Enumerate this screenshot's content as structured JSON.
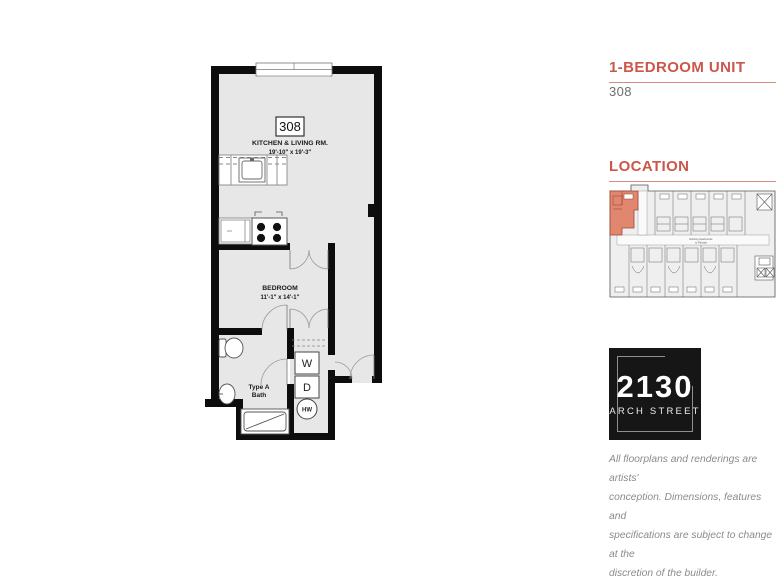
{
  "header": {
    "unit_type_heading": "1-BEDROOM UNIT",
    "unit_number": "308",
    "location_heading": "LOCATION"
  },
  "floorplan": {
    "unit_number": "308",
    "rooms": {
      "living": {
        "name": "KITCHEN & LIVING RM.",
        "dimensions": "19'-10\" x 19'-3\""
      },
      "bedroom": {
        "name": "BEDROOM",
        "dimensions": "11'-1\" x 14'-1\""
      },
      "bath": {
        "name_line1": "Type A",
        "name_line2": "Bath"
      }
    },
    "fixtures": {
      "washer": "W",
      "dryer": "D",
      "water_heater": "HW"
    }
  },
  "location_map": {
    "highlighted_unit": "308",
    "corridor_note_line1": "Existing Apartments",
    "corridor_note_line2": "to Remain"
  },
  "logo": {
    "number": "2130",
    "street": "ARCH STREET"
  },
  "disclaimer": {
    "line1": "All floorplans and renderings are artists'",
    "line2": "conception. Dimensions, features and",
    "line3": "specifications are subject to change at the",
    "line4": "discretion of the builder."
  },
  "colors": {
    "accent_red": "#cb574a",
    "underline_red": "#d88c80",
    "highlight_unit_fill": "#e2876f",
    "wall_black": "#0d0d0d",
    "floor_gray": "#e7e7e7",
    "logo_background": "#161616",
    "disclaimer_gray": "#8b8b8b"
  }
}
